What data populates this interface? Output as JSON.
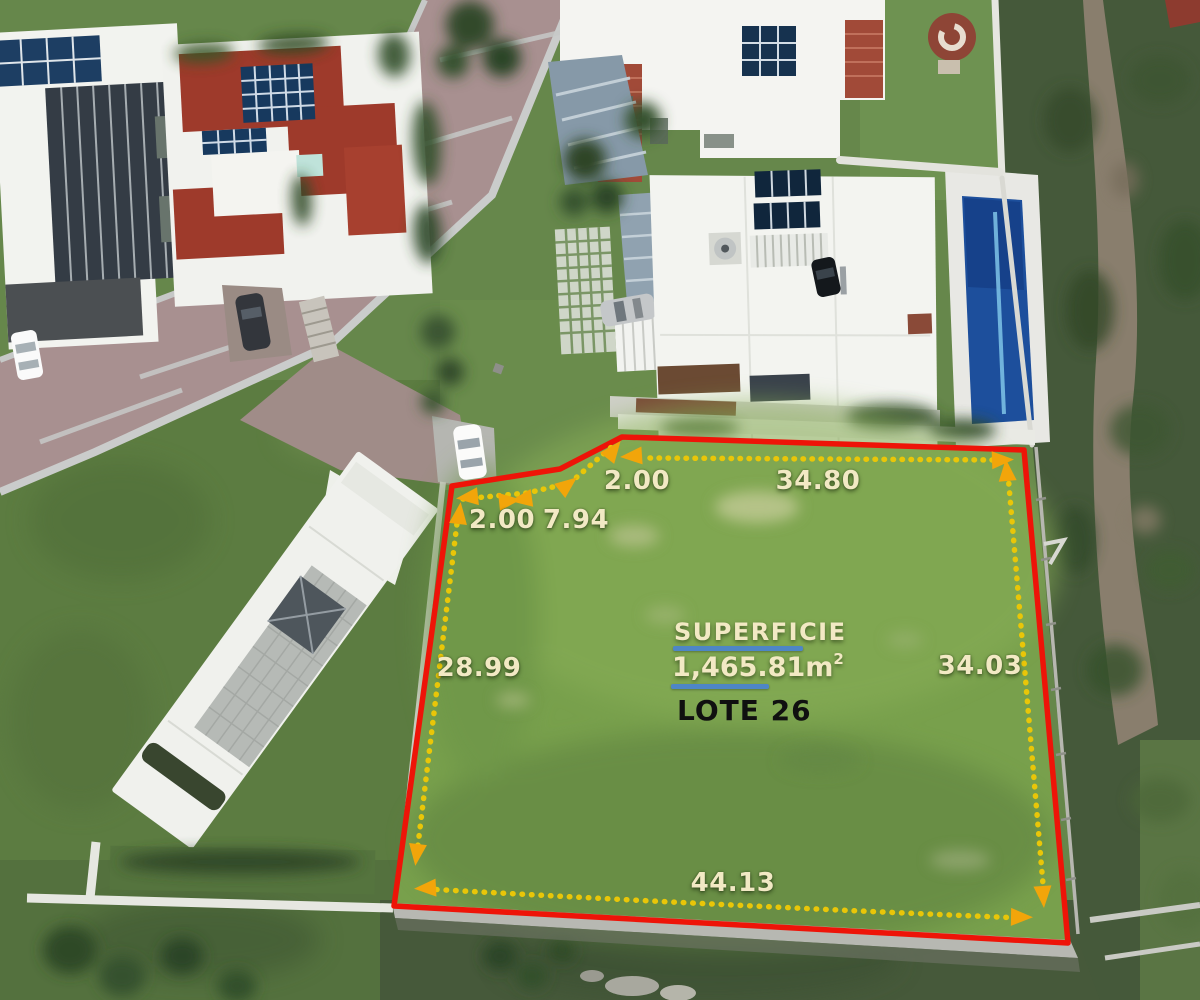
{
  "image_type": "aerial-drone-photo-of-lot-for-sale",
  "labels": {
    "superficie": "SUPERFICIE",
    "area_value": "1,465.81",
    "area_unit": "m",
    "area_sup": "2",
    "lote": "LOTE 26"
  },
  "measurements": {
    "seg_a": "2.00",
    "seg_b": "7.94",
    "seg_c": "2.00",
    "top": "34.80",
    "left": "28.99",
    "right": "34.03",
    "bottom": "44.13"
  },
  "colors": {
    "boundary_red": "#ee1408",
    "dot_yellow": "#e9c608",
    "arrow_orange": "#f2a50a",
    "label_cream": "#f2e9c4",
    "underline_blue": "#4e86c6",
    "lote_black": "#101010",
    "lot_grass_green": "#78a04c",
    "pool_blue": "#1d4f9c"
  }
}
